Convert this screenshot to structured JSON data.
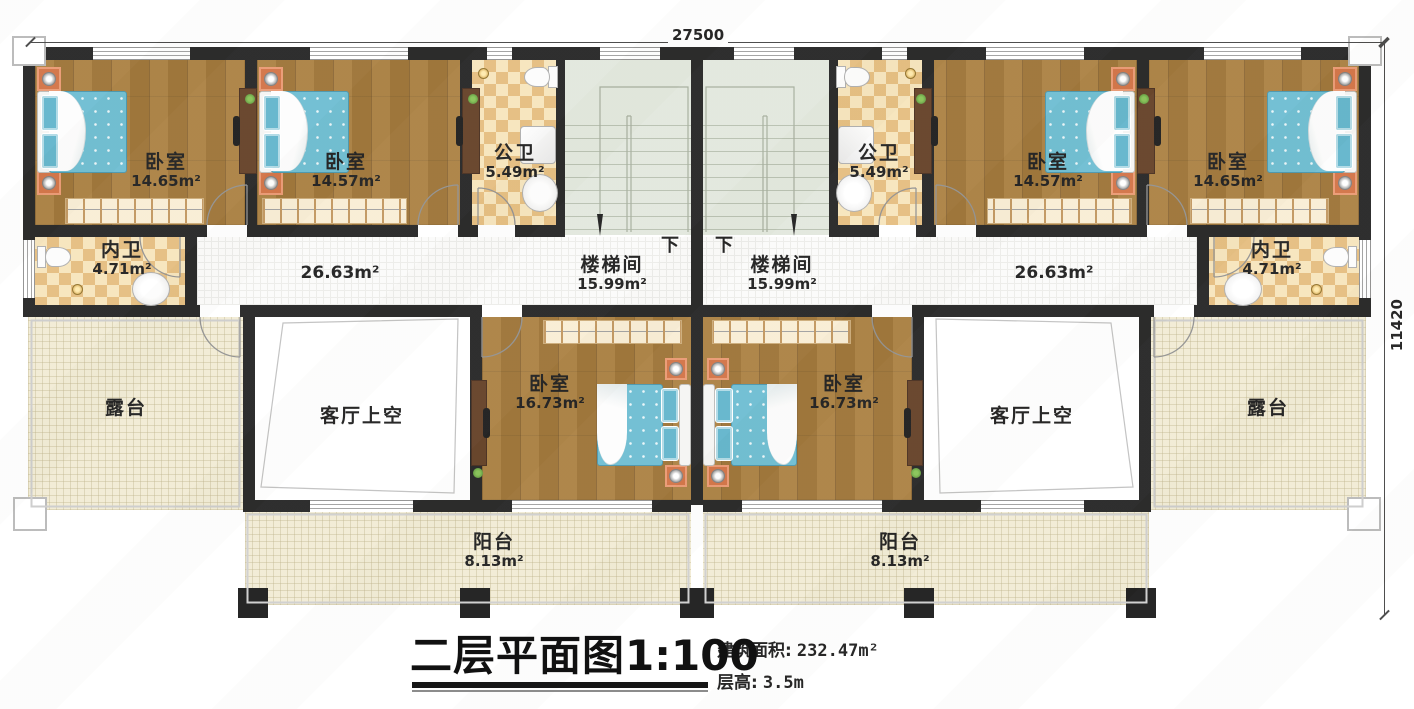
{
  "dimensions": {
    "width": "27500",
    "height": "11420"
  },
  "title": {
    "main": "二层平面图",
    "scale": "1:100"
  },
  "info": {
    "area_label": "建筑面积:",
    "area_value": "232.47m²",
    "height_label": "层高:",
    "height_value": "3.5m"
  },
  "stair": {
    "down": "下"
  },
  "rooms": {
    "bedroom_a": {
      "name": "卧室",
      "area": "14.65m²"
    },
    "bedroom_b": {
      "name": "卧室",
      "area": "14.57m²"
    },
    "bath_public": {
      "name": "公卫",
      "area": "5.49m²"
    },
    "stairwell": {
      "name": "楼梯间",
      "area": "15.99m²"
    },
    "bath_inner": {
      "name": "内卫",
      "area": "4.71m²"
    },
    "corridor": {
      "area": "26.63m²"
    },
    "terrace": {
      "name": "露台"
    },
    "living_void": {
      "name": "客厅上空"
    },
    "bedroom_c": {
      "name": "卧室",
      "area": "16.73m²"
    },
    "balcony": {
      "name": "阳台",
      "area": "8.13m²"
    }
  }
}
